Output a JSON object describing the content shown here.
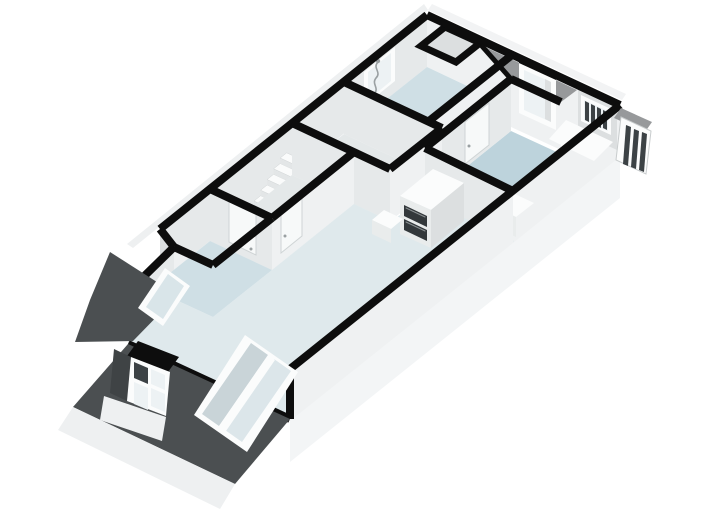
{
  "app": {
    "view_label": "3d-floorplan-render"
  },
  "canvas": {
    "width": 720,
    "height": 509,
    "background": "#ffffff"
  },
  "colors": {
    "wallTop": "#0d0d0d",
    "faceLight": "#e6e9ea",
    "faceLighter": "#eff1f2",
    "faceLighter2": "#e9ecec",
    "faceMid": "#dcdfe0",
    "floorBlue": "#bdd3dc",
    "floorPale": "#dfe9ec",
    "floorPale2": "#cfdfe5",
    "floorGray": "#e4e8e9",
    "slopeDark": "#4b4f51",
    "slopeDarker": "#3f4345",
    "slopeMid": "#97999b",
    "tubBlue": "#2f9fc9",
    "tubBlueDark": "#2b88ad",
    "tubBlueLight": "#7cc4e0",
    "glass": "#dce6ea",
    "glassShadow": "#c9d4d8",
    "glassPale": "#edf2f4",
    "glassPaleBlue": "#d9e5e9",
    "white": "#fbfcfc",
    "doorWhite": "#f7f9f9",
    "doorEdge": "#cfd4d5",
    "ovenDark": "#33383b",
    "paneDark": "#3c4245",
    "skirt": "#f3f5f6",
    "skirt2": "#eef0f1",
    "outerStrip": "#eef0f1",
    "outerStrip2": "#f2f3f4",
    "metal": "#9aa0a2",
    "stepWhite": "#fafbfb",
    "stepRiser": "#e3e6e7",
    "stepSide": "#d7dbdc",
    "background": "#ffffff"
  },
  "scene": {
    "rooms": [
      {
        "id": "bedroom",
        "floor_color": "floorBlue"
      },
      {
        "id": "bathroom",
        "floor_color": "floorPale2"
      },
      {
        "id": "closet",
        "floor_color": "faceMid"
      },
      {
        "id": "hallway",
        "floor_color": "floorGray"
      },
      {
        "id": "corridor",
        "floor_color": "floorGray"
      },
      {
        "id": "study",
        "floor_color": "floorPale2"
      },
      {
        "id": "living-room",
        "floor_color": "floorPale"
      }
    ],
    "fixtures": [
      "staircase",
      "bathtub",
      "shower-hose",
      "oven-cabinet",
      "kitchen-counter",
      "bedroom-low-unit"
    ],
    "openings": [
      "bathroom-window",
      "dormer-window",
      "mullioned-window",
      "chamfer-window",
      "bay-window",
      "front-sliding-window",
      "bedroom-door",
      "corridor-door",
      "study-door",
      "balcony-frame"
    ]
  }
}
